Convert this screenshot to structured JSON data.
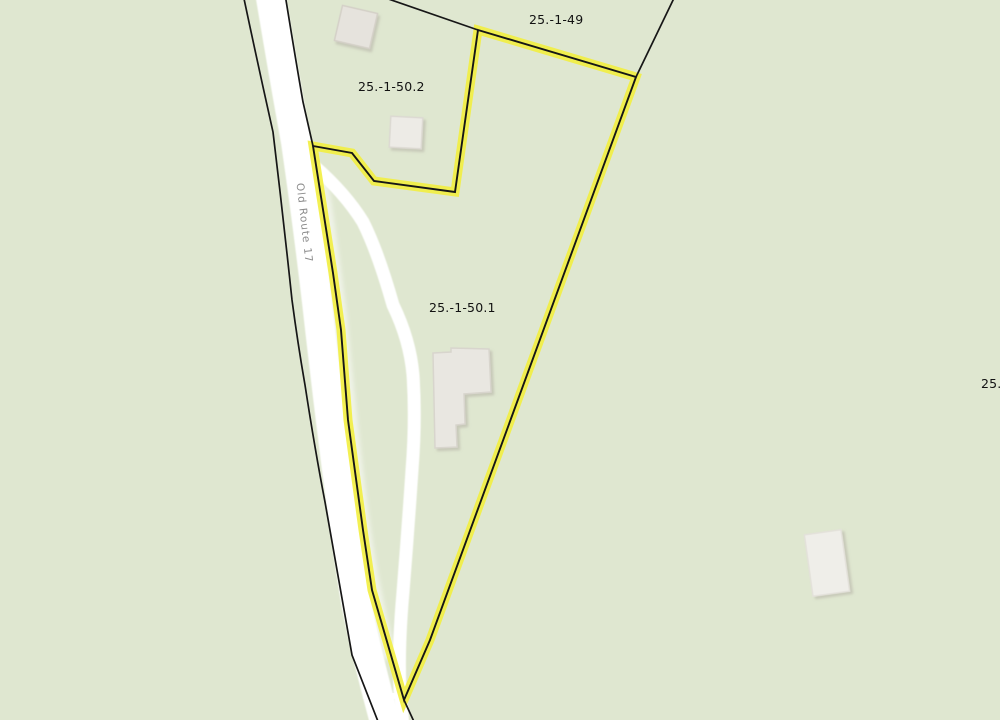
{
  "map": {
    "background_color": "#dfe7d0",
    "highlight_color": "#f2ee3f",
    "boundary_color": "#161616",
    "road_fill_color": "#ffffff",
    "road_label": "Old Route 17",
    "parcel_labels": [
      {
        "id": "25.-1-49"
      },
      {
        "id": "25.-1-50.2"
      },
      {
        "id": "25.-1-50.1"
      },
      {
        "id": "25."
      }
    ]
  }
}
